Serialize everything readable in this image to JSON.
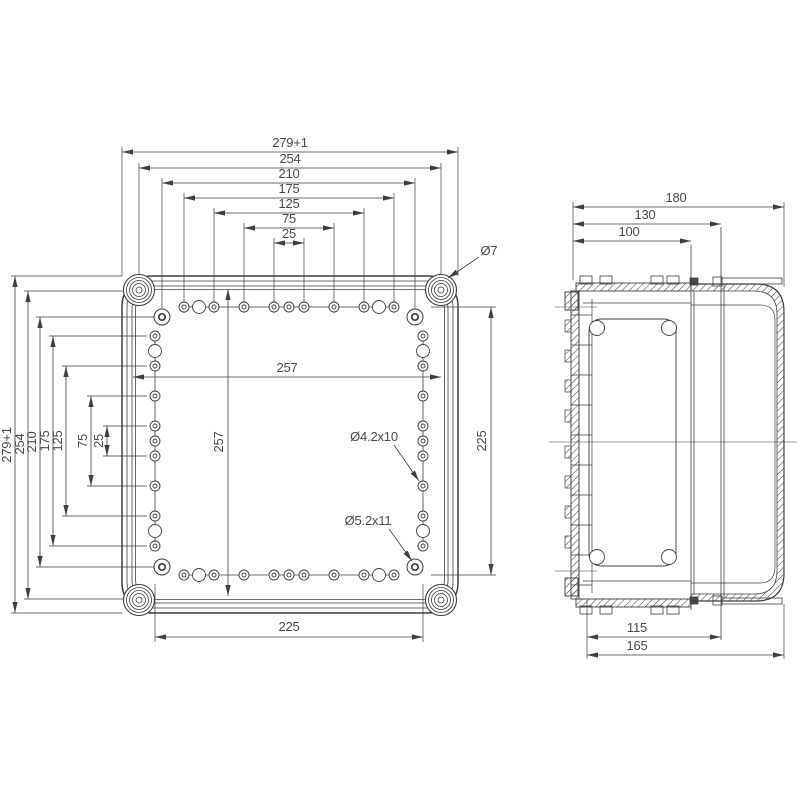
{
  "colors": {
    "line": "#3f3f3f",
    "text": "#4a4a4a",
    "background": "#ffffff"
  },
  "front_view": {
    "horizontal_dims": [
      "279+1",
      "254",
      "210",
      "175",
      "125",
      "75",
      "25"
    ],
    "vertical_dims": [
      "279+1",
      "254",
      "210",
      "175",
      "125",
      "75",
      "25"
    ],
    "inner_width": "257",
    "inner_height": "257",
    "hole_span_width": "225",
    "hole_span_height": "225",
    "corner_screw_dia": "Ø7",
    "small_hole_spec": "Ø4.2x10",
    "corner_hole_spec": "Ø5.2x11"
  },
  "side_view": {
    "depth_dims": [
      "180",
      "130",
      "100"
    ],
    "bottom_dims": [
      "115",
      "165"
    ]
  }
}
